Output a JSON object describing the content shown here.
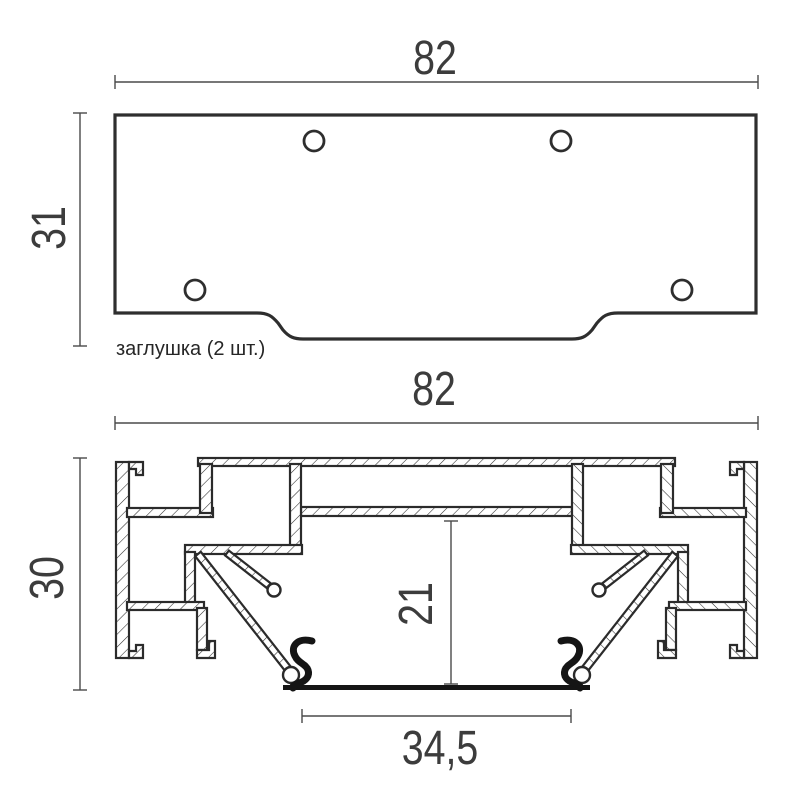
{
  "colors": {
    "background": "#ffffff",
    "outline": "#2b2b2b",
    "dimension_lines": "#4a4a4a",
    "label_text": "#3c3c3c",
    "gasket": "#151515"
  },
  "top_view": {
    "caption": "заглушка (2 шт.)",
    "dim_width": "82",
    "dim_height": "31",
    "hole_count": 4
  },
  "section_view": {
    "dim_width": "82",
    "dim_height": "30",
    "dim_channel_height": "21",
    "dim_channel_width": "34,5"
  }
}
